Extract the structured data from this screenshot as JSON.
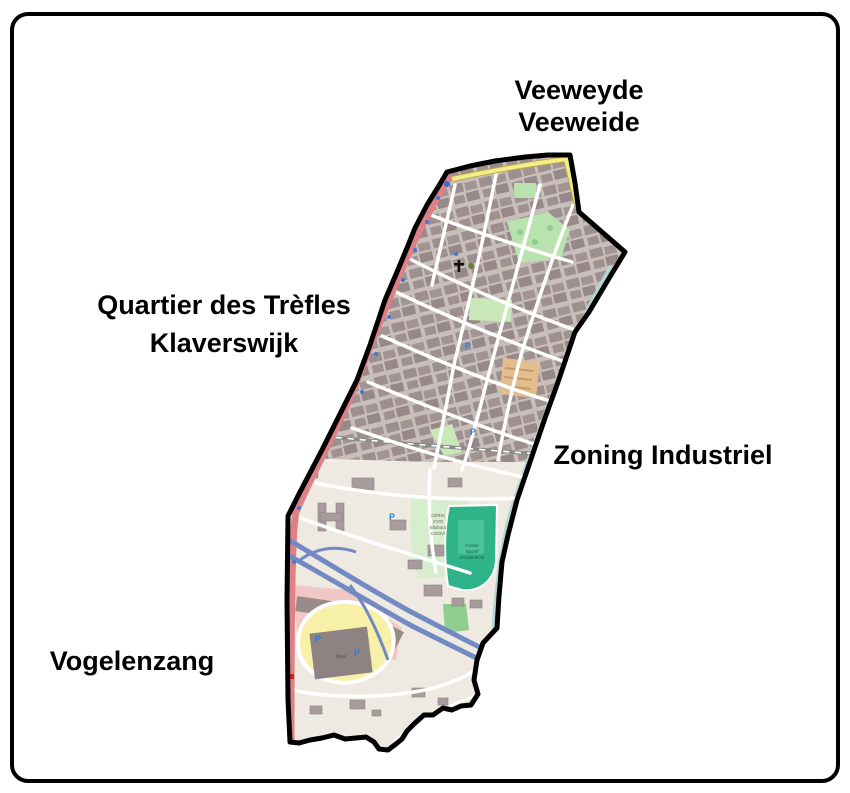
{
  "figure": {
    "type": "neighborhood-map",
    "background": "#ffffff",
    "frame_color": "#000000",
    "boundary_color": "#000000"
  },
  "neighborhood_labels": {
    "top": [
      "Veeweyde",
      "Veeweide"
    ],
    "left": [
      "Quartier des Trèfles",
      "Klaverswijk"
    ],
    "right": [
      "Zoning Industriel"
    ],
    "bottom": [
      "Vogelenzang"
    ]
  },
  "map_labels": {
    "ceria_lines": [
      "CERIA",
      "CVO",
      "Elishout",
      "COOVI"
    ],
    "sport_lines": [
      "Centre",
      "Sportif",
      "d'Anderlecht"
    ],
    "ikea": "Ikea",
    "parking_letter": "P"
  },
  "palette": {
    "map_base": "#f1eee6",
    "urban_block": "#9d8f8f",
    "urban_court": "#c9bfba",
    "industrial_base": "#eeeae1",
    "street": "#ffffff",
    "primary_road": "#df8086",
    "tertiary_road": "#f2ee86",
    "motorway": "#7289c2",
    "railway": "#8a8a8a",
    "park_green": "#b8e3ae",
    "campus_green": "#d6eecd",
    "sports_green": "#2fb389",
    "field_green": "#8fce8f",
    "retail_pink": "#f0c6c6",
    "parking_yellow": "#f6f0a8",
    "construction_orange": "#e3bd8e",
    "quay_teal": "#b2d6d3",
    "poi_blue": "#3b7bd4"
  }
}
